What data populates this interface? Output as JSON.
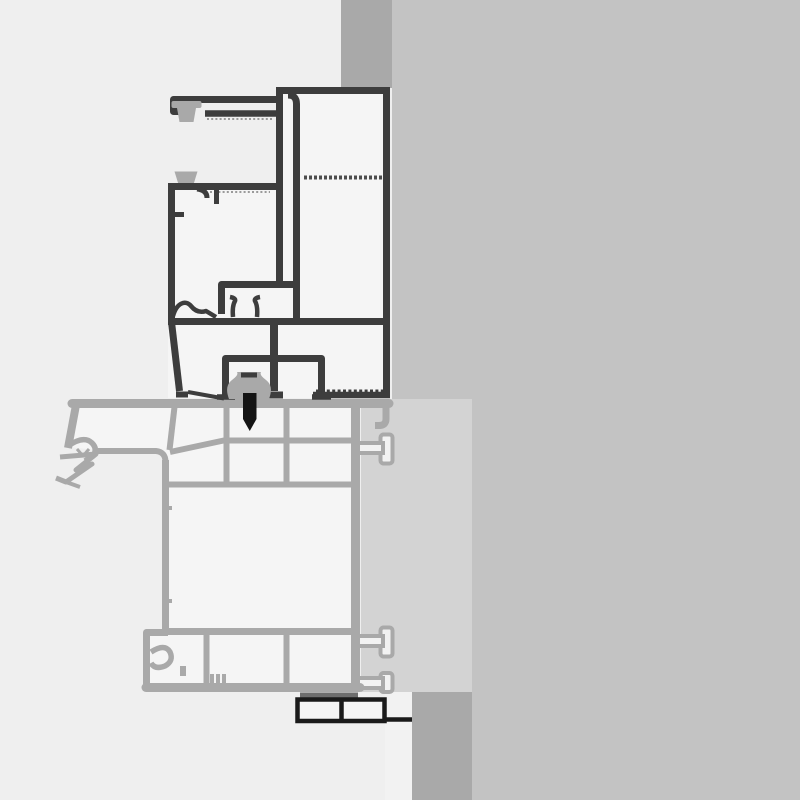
{
  "diagram": {
    "type": "technical-cross-section",
    "subject": "Aluminium window frame profile on sill profile with wall, subframe column, fixing screw and anchors",
    "parts": [
      "wall",
      "wall-band-top",
      "wall-band-bottom",
      "subframe-column",
      "frame-profile",
      "frame-top-arm",
      "brush-gasket-top",
      "gasket-mid",
      "glazing-clip-prongs",
      "screw-channel-housing",
      "connector-clip",
      "fixing-screw",
      "serrated-flange",
      "sill-profile",
      "sill-drip-nose",
      "sill-anchor-1",
      "sill-anchor-2",
      "sill-anchor-3",
      "bottom-cover-box"
    ]
  },
  "colors": {
    "background": "#efefef",
    "wall": "#c3c3c3",
    "wall_band": "#a9a9a9",
    "subframe_column": "#d3d3d3",
    "white_strip": "#f2f2f2",
    "profile_fill": "#f5f5f5",
    "frame_stroke": "#3d3d3d",
    "sill_stroke": "#a9a9a9",
    "screw": "#141414",
    "box_stroke": "#1a1a1a",
    "thin_bar": "#6e6e6e"
  }
}
